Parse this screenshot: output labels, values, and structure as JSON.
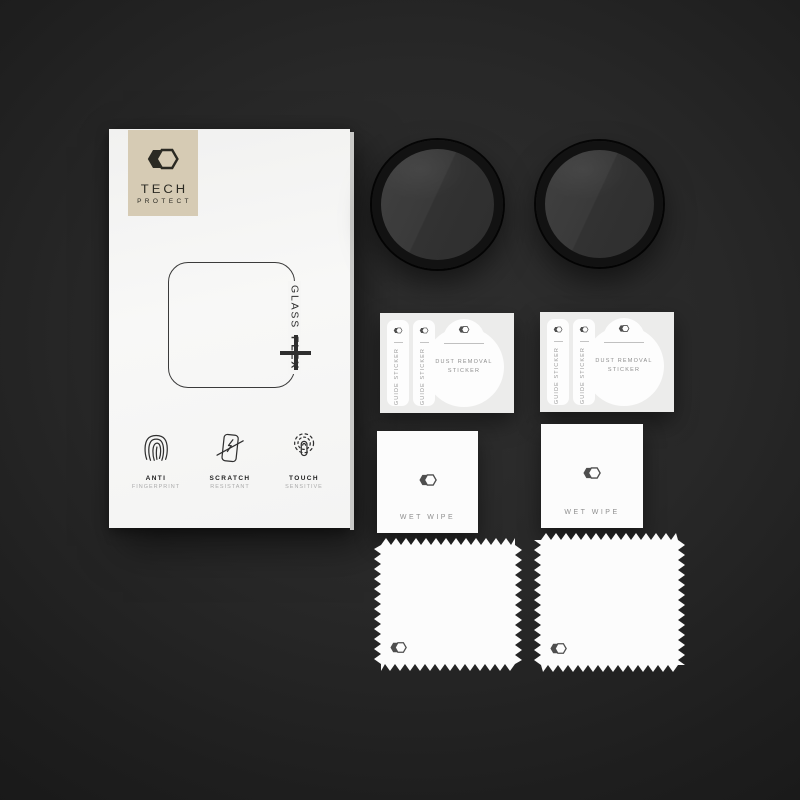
{
  "scene": {
    "type": "product-photo",
    "subject": "Watch screen protector kit laid out on dark surface",
    "background_color": "#1e1e1e"
  },
  "box": {
    "brand": {
      "line1": "TECH",
      "line2": "PROTECT"
    },
    "logo": {
      "icon": "hexagon-icon",
      "badge_color": "#d6cbb4"
    },
    "product": {
      "glass": "GLASS",
      "flex": "FLEX"
    },
    "features": [
      {
        "icon": "fingerprint-icon",
        "title": "ANTI",
        "subtitle": "FINGERPRINT"
      },
      {
        "icon": "scratch-resistant-icon",
        "title": "SCRATCH",
        "subtitle": "RESISTANT"
      },
      {
        "icon": "touch-sensitive-icon",
        "title": "TOUCH",
        "subtitle": "SENSITIVE"
      }
    ]
  },
  "accessories": {
    "glass_protectors": {
      "count": 2,
      "shape": "round",
      "rim_color": "#121212"
    },
    "sticker_sheets": {
      "count": 2,
      "guide_sticker_label": "GUIDE STICKER",
      "dust_removal_label_line1": "DUST REMOVAL",
      "dust_removal_label_line2": "STICKER"
    },
    "wet_wipes": {
      "count": 2,
      "label": "WET WIPE"
    },
    "microfiber_cloths": {
      "count": 2
    }
  },
  "colors": {
    "box_white": "#f6f6f5",
    "logo_beige": "#d6cbb4",
    "logo_ink": "#2b2a23",
    "card_gray": "#ececeb",
    "glass_face": "#383838",
    "background_dark": "#141414"
  }
}
